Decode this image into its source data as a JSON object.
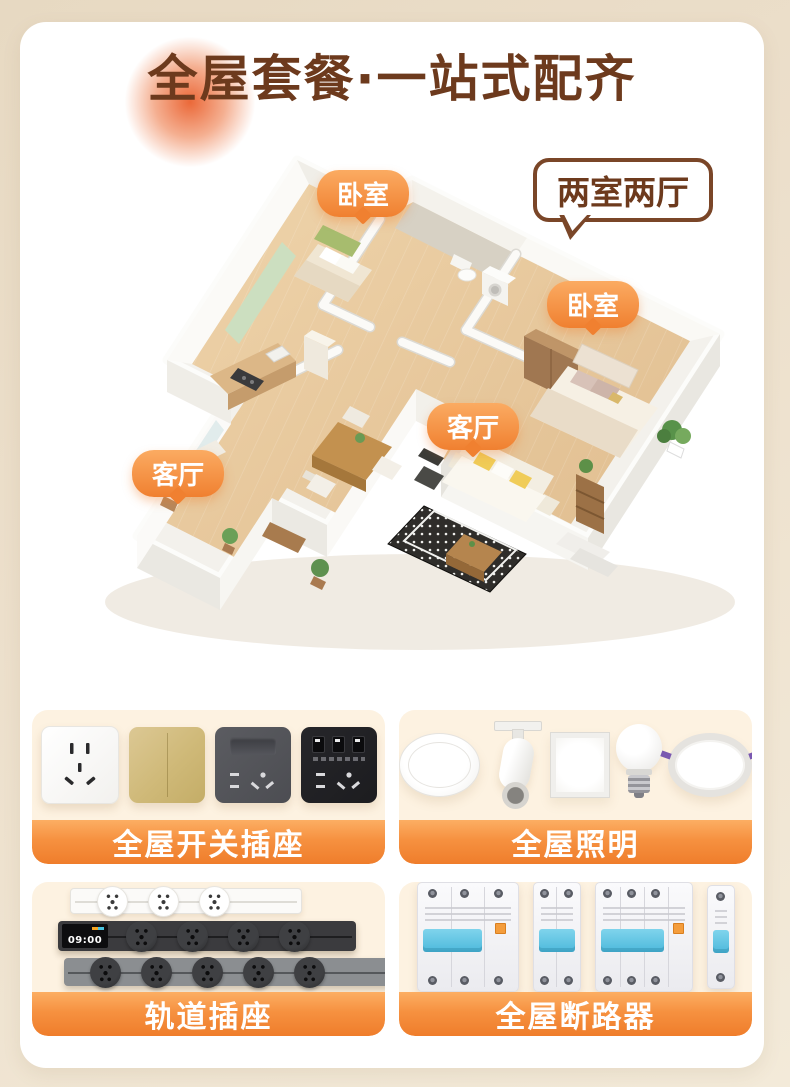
{
  "header": {
    "title": "全屋套餐·一站式配齐"
  },
  "floorplan": {
    "type_bubble": "两室两厅",
    "room_labels": [
      {
        "id": "bedroom-1",
        "text": "卧室"
      },
      {
        "id": "bedroom-2",
        "text": "卧室"
      },
      {
        "id": "living-1",
        "text": "客厅"
      },
      {
        "id": "living-2",
        "text": "客厅"
      }
    ]
  },
  "product_cards": [
    {
      "label": "全屋开关插座",
      "items": [
        "white-five-hole-socket",
        "gold-double-rocker-switch",
        "gray-switch-with-socket",
        "black-usb-socket"
      ]
    },
    {
      "label": "全屋照明",
      "items": [
        "round-ceiling-light",
        "track-spotlight",
        "led-panel-light",
        "led-bulb",
        "recessed-downlight"
      ]
    },
    {
      "label": "轨道插座",
      "screen_time": "09:00",
      "items": [
        "white-track-3-sockets",
        "black-track-with-screen-4-sockets",
        "gray-track-5-sockets"
      ]
    },
    {
      "label": "全屋断路器",
      "items": [
        "2p-rcbo-wide",
        "2p-breaker",
        "3p-rcbo",
        "1p-breaker"
      ]
    }
  ],
  "colors": {
    "accent_orange": "#F08030",
    "banner_top": "#FCAE63",
    "banner_bottom": "#EF7D2B",
    "title_brown": "#6D3A1D",
    "bubble_border": "#7A4628",
    "page_bg": "#EBDFC9",
    "card_bg": "#FDF2E1"
  }
}
